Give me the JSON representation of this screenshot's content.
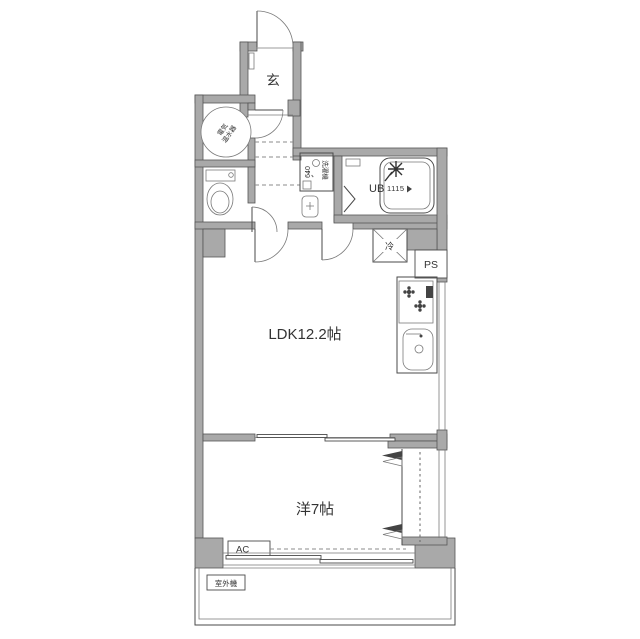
{
  "floorplan": {
    "type": "apartment-floor-plan",
    "labels": {
      "entrance": "玄",
      "water_heater_line1": "電気",
      "water_heater_line2": "温水器",
      "washer_size": "640",
      "washer": "洗濯機",
      "unit_bath": "UB",
      "unit_bath_size": "1115",
      "refrigerator": "冷",
      "pipe_space": "PS",
      "ldk": "LDK12.2帖",
      "bedroom": "洋7帖",
      "air_conditioner": "AC",
      "outdoor_unit": "室外機"
    },
    "colors": {
      "wall_fill": "#a9a9a9",
      "wall_edge": "#555555",
      "line": "#4a4a4a",
      "fixture": "#8a8a8a",
      "text": "#333333",
      "background": "#ffffff"
    }
  }
}
